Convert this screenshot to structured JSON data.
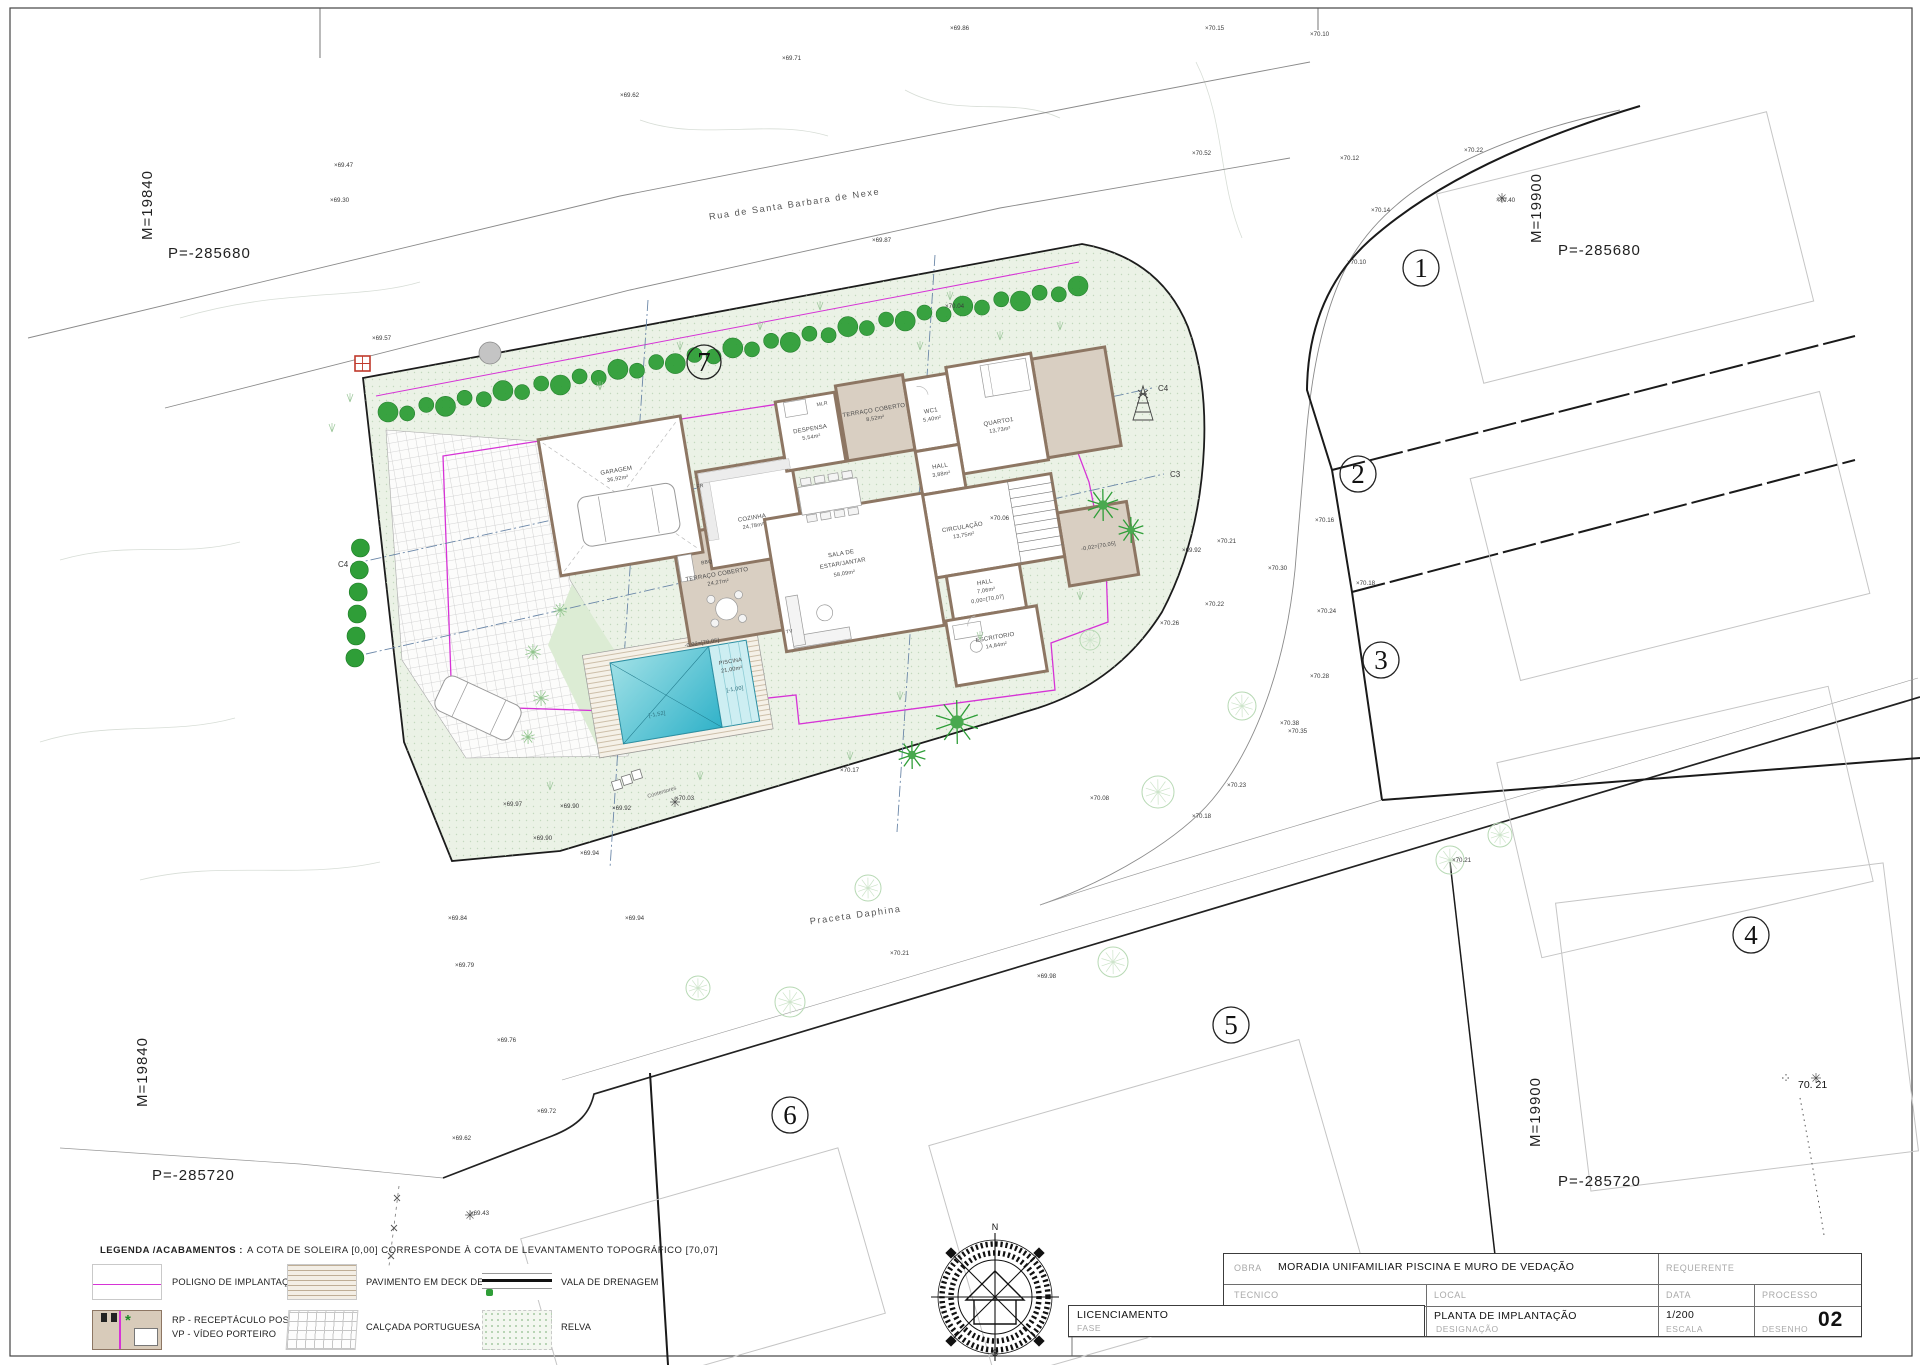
{
  "drawing": {
    "corners": {
      "tl": {
        "m": "M=19840",
        "p": "P=-285680"
      },
      "tr": {
        "m": "M=19900",
        "p": "P=-285680"
      },
      "bl": {
        "m": "M=19840",
        "p": "P=-285720"
      },
      "br": {
        "m": "M=19900",
        "p": "P=-285720"
      }
    },
    "streets": {
      "rua": "Rua de Santa Barbara de Nexe",
      "praceta": "Praceta Daphina"
    },
    "lot_numbers": [
      "1",
      "2",
      "3",
      "4",
      "5",
      "6",
      "7"
    ],
    "sections": {
      "c3": "C3",
      "c4": "C4"
    },
    "elevation_note": "70. 21",
    "contentores": "Contentores",
    "spot_marker": "×",
    "spots": [
      {
        "x": 334,
        "y": 167,
        "v": "69.47"
      },
      {
        "x": 330,
        "y": 202,
        "v": "69.30"
      },
      {
        "x": 372,
        "y": 340,
        "v": "69.57"
      },
      {
        "x": 620,
        "y": 97,
        "v": "69.62"
      },
      {
        "x": 782,
        "y": 60,
        "v": "69.71"
      },
      {
        "x": 950,
        "y": 30,
        "v": "69.86"
      },
      {
        "x": 1205,
        "y": 30,
        "v": "70.15"
      },
      {
        "x": 1310,
        "y": 36,
        "v": "70.10"
      },
      {
        "x": 872,
        "y": 242,
        "v": "69.87"
      },
      {
        "x": 1192,
        "y": 155,
        "v": "70.52"
      },
      {
        "x": 1340,
        "y": 160,
        "v": "70.12"
      },
      {
        "x": 1464,
        "y": 152,
        "v": "70.22"
      },
      {
        "x": 1496,
        "y": 202,
        "v": "70.40"
      },
      {
        "x": 1371,
        "y": 212,
        "v": "70.14"
      },
      {
        "x": 1347,
        "y": 264,
        "v": "70.10"
      },
      {
        "x": 1315,
        "y": 522,
        "v": "70.16"
      },
      {
        "x": 1356,
        "y": 585,
        "v": "70.18"
      },
      {
        "x": 1217,
        "y": 543,
        "v": "70.21"
      },
      {
        "x": 1268,
        "y": 570,
        "v": "70.30"
      },
      {
        "x": 1182,
        "y": 552,
        "v": "69.92"
      },
      {
        "x": 1205,
        "y": 606,
        "v": "70.22"
      },
      {
        "x": 1317,
        "y": 613,
        "v": "70.24"
      },
      {
        "x": 1160,
        "y": 625,
        "v": "70.26"
      },
      {
        "x": 1310,
        "y": 678,
        "v": "70.28"
      },
      {
        "x": 1280,
        "y": 725,
        "v": "70.38"
      },
      {
        "x": 1288,
        "y": 733,
        "v": "70.35"
      },
      {
        "x": 1227,
        "y": 787,
        "v": "70.23"
      },
      {
        "x": 1192,
        "y": 818,
        "v": "70.18"
      },
      {
        "x": 945,
        "y": 308,
        "v": "70.04"
      },
      {
        "x": 990,
        "y": 520,
        "v": "70.06"
      },
      {
        "x": 1090,
        "y": 800,
        "v": "70.08"
      },
      {
        "x": 890,
        "y": 955,
        "v": "70.21"
      },
      {
        "x": 1037,
        "y": 978,
        "v": "69.98"
      },
      {
        "x": 625,
        "y": 920,
        "v": "69.94"
      },
      {
        "x": 840,
        "y": 772,
        "v": "70.17"
      },
      {
        "x": 503,
        "y": 806,
        "v": "69.97"
      },
      {
        "x": 560,
        "y": 808,
        "v": "69.90"
      },
      {
        "x": 612,
        "y": 810,
        "v": "69.92"
      },
      {
        "x": 533,
        "y": 840,
        "v": "69.90"
      },
      {
        "x": 580,
        "y": 855,
        "v": "69.94"
      },
      {
        "x": 448,
        "y": 920,
        "v": "69.84"
      },
      {
        "x": 455,
        "y": 967,
        "v": "69.79"
      },
      {
        "x": 497,
        "y": 1042,
        "v": "69.76"
      },
      {
        "x": 537,
        "y": 1113,
        "v": "69.72"
      },
      {
        "x": 452,
        "y": 1140,
        "v": "69.62"
      },
      {
        "x": 470,
        "y": 1215,
        "v": "69.43"
      },
      {
        "x": 675,
        "y": 800,
        "v": "70.03"
      },
      {
        "x": 1452,
        "y": 862,
        "v": "70.21"
      }
    ]
  },
  "house": {
    "rooms": {
      "garagem": {
        "name": "GARAGEM",
        "area": "36,92m²"
      },
      "cozinha": {
        "name": "COZINHA",
        "area": "24,78m²"
      },
      "despensa": {
        "name": "DESPENSA",
        "area": "5,54m²"
      },
      "terraco1": {
        "name": "TERRAÇO COBERTO",
        "area": "8,52m²"
      },
      "wc1": {
        "name": "WC1",
        "area": "5,40m²"
      },
      "quarto1": {
        "name": "QUARTO1",
        "area": "13,73m²"
      },
      "hall1": {
        "name": "HALL",
        "area": "3,88m²"
      },
      "circulacao": {
        "name": "CIRCULAÇÃO",
        "area": "13,75m²"
      },
      "hall2": {
        "name": "HALL",
        "area": "7,06m²"
      },
      "escritorio": {
        "name": "ESCRITORIO",
        "area": "14,84m²"
      },
      "sala": {
        "name1": "SALA DE",
        "name2": "ESTAR/JANTAR",
        "area": "58,09m²"
      },
      "terraco2": {
        "name": "TERRAÇO COBERTO",
        "area": "24,27m²"
      }
    },
    "piscina": {
      "name": "PISCINA",
      "area": "21,00m²",
      "depth_deep": "[-1,52]",
      "depth_shallow": "[-1,00]"
    },
    "levels": {
      "soleira": "0,00=[70,07]",
      "terraco": "-0,02=[70,05]"
    },
    "tags": {
      "bbq": "BBQ",
      "fr": "FR",
      "tv": "TV",
      "mlr": "MLR"
    }
  },
  "compass": {
    "n": "N",
    "s": "S"
  },
  "legend": {
    "title_bold": "LEGENDA /ACABAMENTOS :",
    "title_rest": "A COTA DE SOLEIRA [0,00] CORRESPONDE À COTA DE LEVANTAMENTO TOPOGRÁFICO [70,07]",
    "poligno": "POLIGNO DE IMPLANTAÇÃO",
    "deck": "PAVIMENTO EM DECK DE MADEIRA",
    "vala": "VALA DE DRENAGEM",
    "rp": "RP - RECEPTÁCULO POSTA",
    "vp": "VP - VÍDEO PORTEIRO",
    "calcada": "CALÇADA PORTUGUESA",
    "relva": "RELVA"
  },
  "titleblock": {
    "obra_label": "OBRA",
    "obra_value": "MORADIA UNIFAMILIAR PISCINA E MURO DE VEDAÇÃO",
    "requerente_label": "REQUERENTE",
    "tecnico_label": "TECNICO",
    "local_label": "LOCAL",
    "data_label": "DATA",
    "processo_label": "PROCESSO",
    "licenciamento_value": "LICENCIAMENTO",
    "fase_label": "FASE",
    "designacao_value": "PLANTA DE IMPLANTAÇÃO",
    "designacao_label": "DESIGNAÇÃO",
    "escala_value": "1/200",
    "escala_label": "ESCALA",
    "desenho_label": "DESENHO",
    "drawing_number": "02"
  }
}
